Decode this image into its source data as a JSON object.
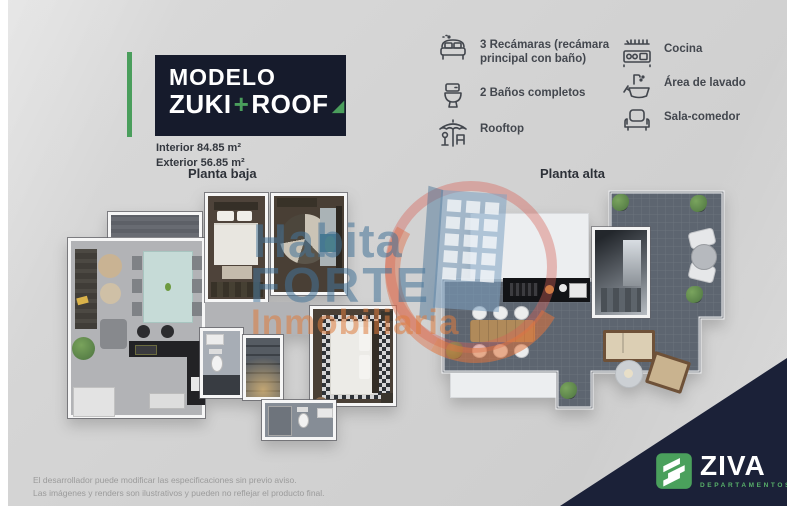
{
  "header": {
    "title_line1": "MODELO",
    "title_zuki": "ZUKI",
    "title_plus": "+",
    "title_roof": "ROOF",
    "title_triangle": "◢",
    "interior": "Interior 84.85 m²",
    "exterior": "Exterior 56.85 m²",
    "accent_green": "#4a9e5c",
    "navy": "#161b2c"
  },
  "features": {
    "left": [
      {
        "icon": "bed-icon",
        "label": "3 Recámaras (recámara principal con baño)"
      },
      {
        "icon": "toilet-icon",
        "label": "2 Baños completos"
      },
      {
        "icon": "rooftop-umbrella-icon",
        "label": "Rooftop"
      }
    ],
    "right": [
      {
        "icon": "kitchen-stove-icon",
        "label": "Cocina"
      },
      {
        "icon": "laundry-sink-icon",
        "label": "Área de lavado"
      },
      {
        "icon": "sofa-icon",
        "label": "Sala-comedor"
      }
    ]
  },
  "plans": {
    "left_label": "Planta baja",
    "right_label": "Planta alta"
  },
  "watermark": {
    "line1": "Habita",
    "line2": "FORTE",
    "line3": "Inmobiliaria"
  },
  "footer": {
    "disclaimer_line1": "El desarrollador puede modificar las especificaciones sin previo aviso.",
    "disclaimer_line2": "Las imágenes y renders son ilustrativos y pueden no reflejar el producto final.",
    "brand": "ZIVA",
    "brand_sub": "DEPARTAMENTOS"
  }
}
